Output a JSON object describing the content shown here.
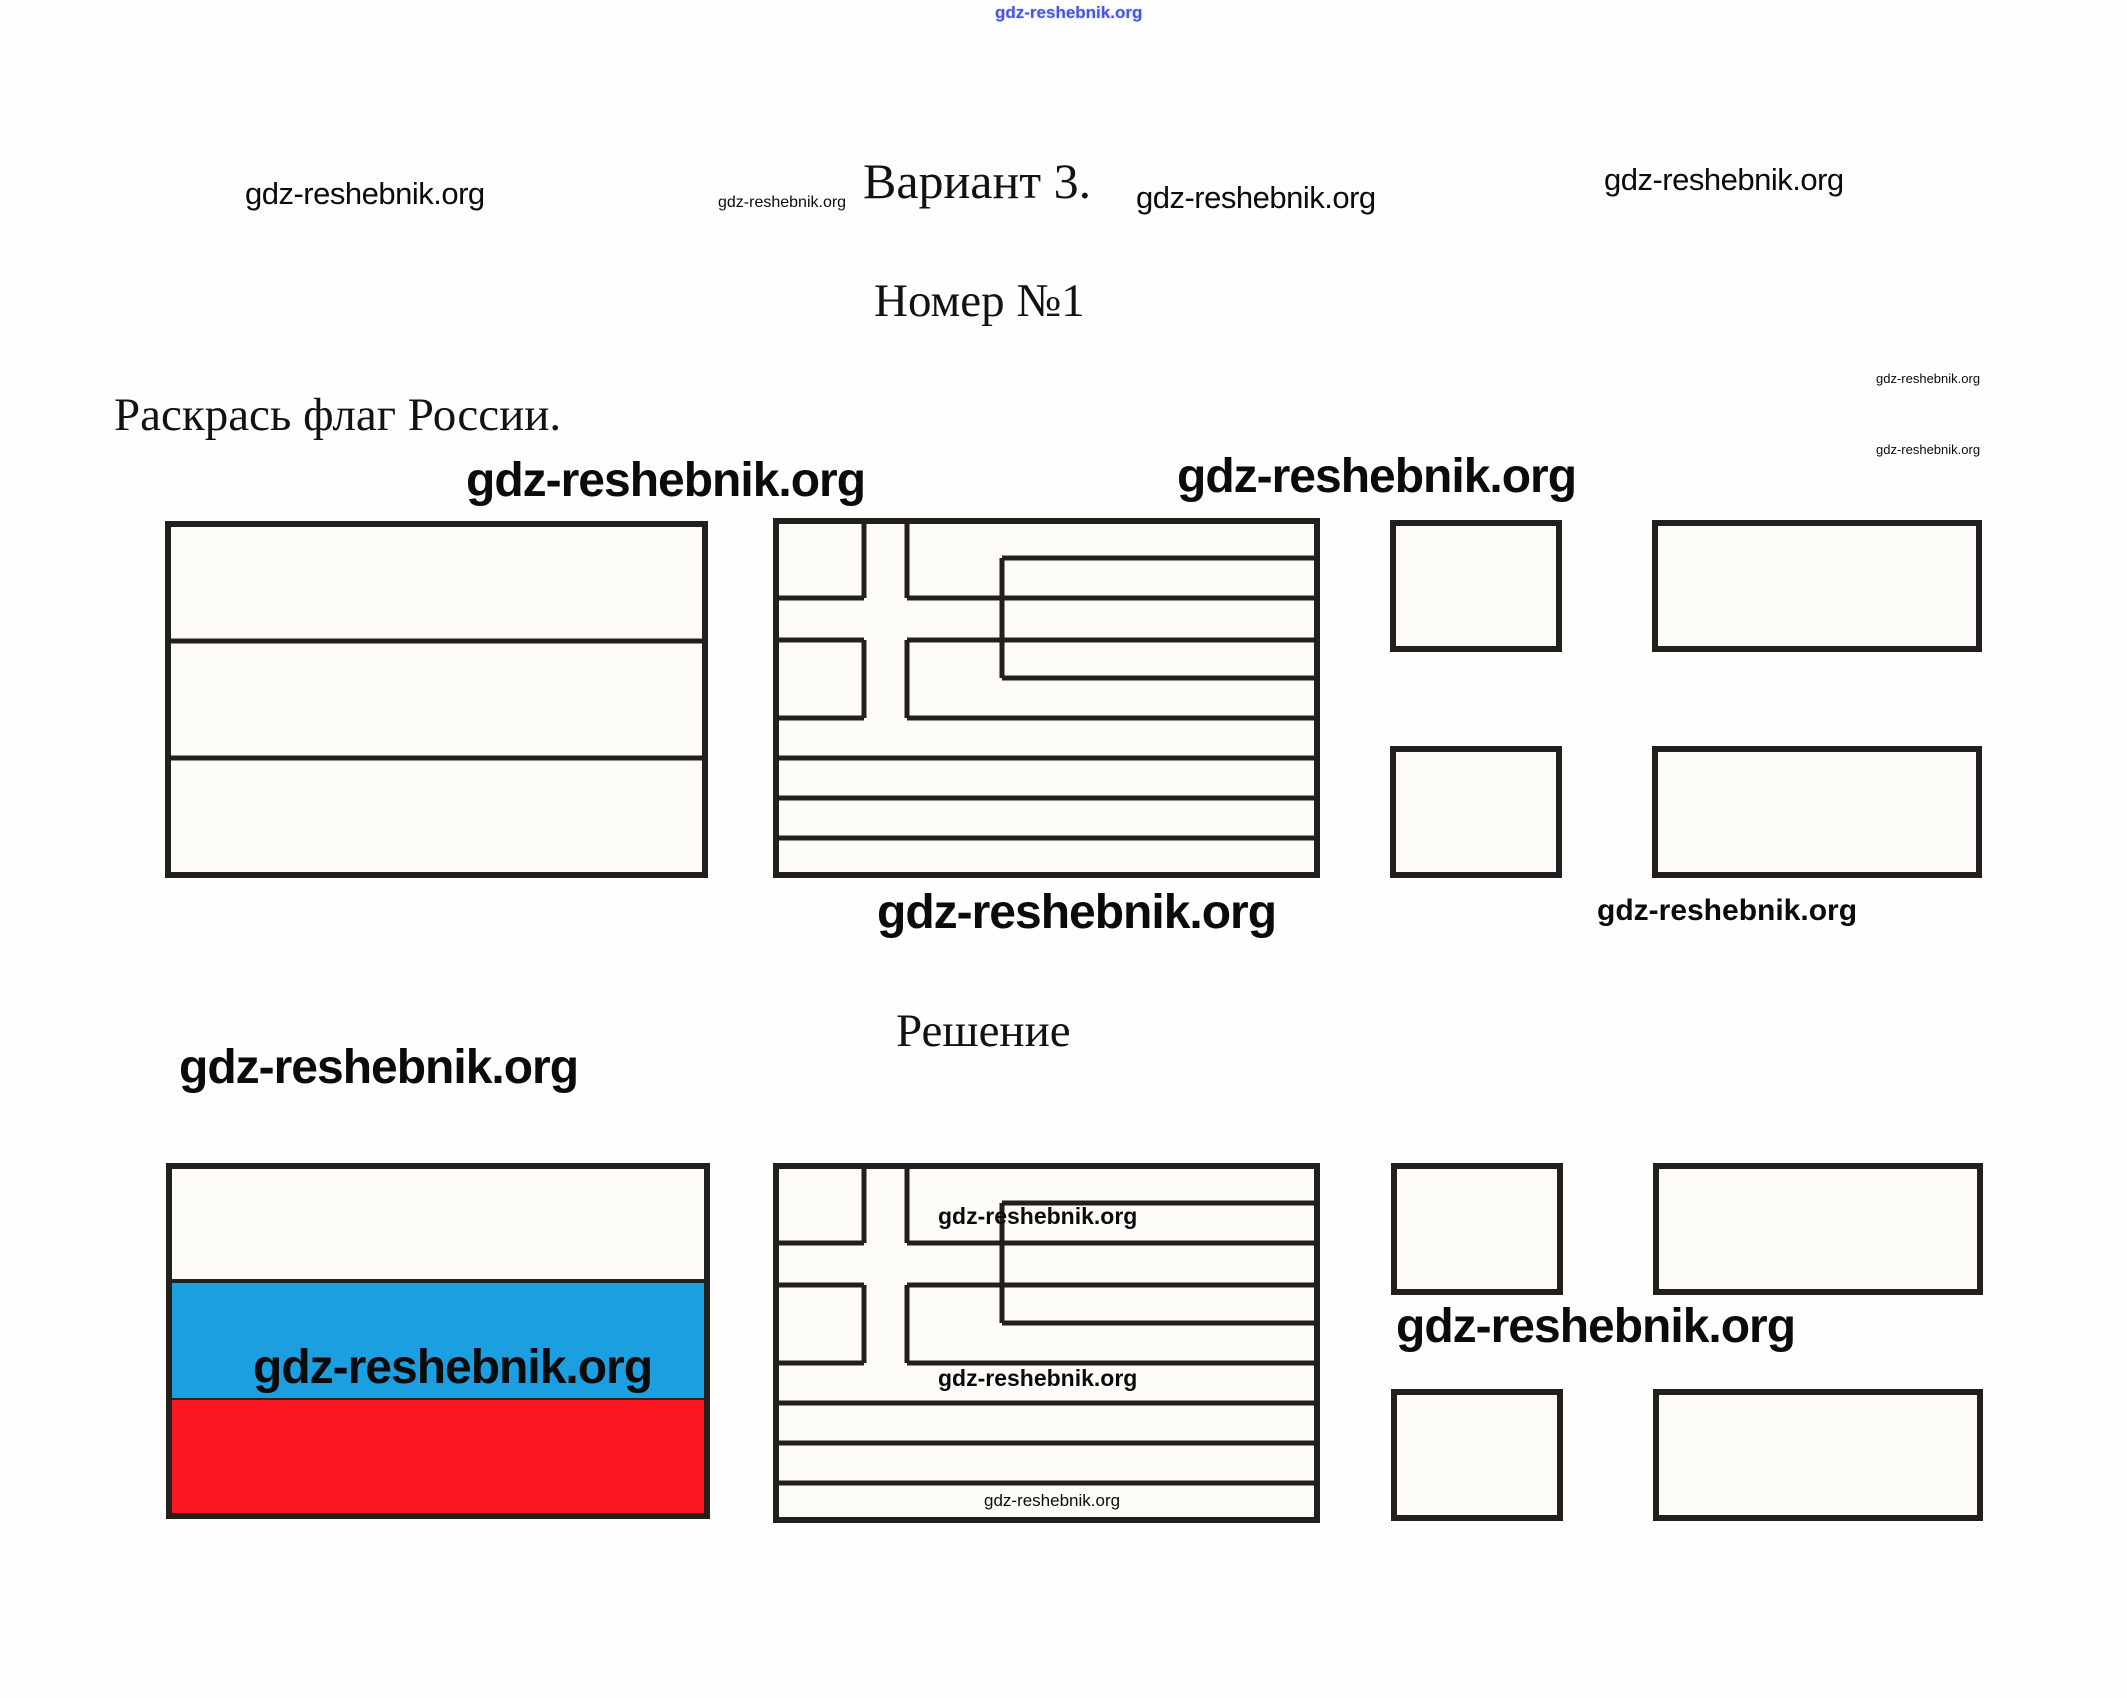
{
  "site": "gdz-reshebnik.org",
  "header": {
    "top_watermark": "gdz-reshebnik.org",
    "left_watermark": "gdz-reshebnik.org",
    "small_watermark": "gdz-reshebnik.org",
    "variant_title": "Вариант 3.",
    "variant_watermark": "gdz-reshebnik.org",
    "right_watermark": "gdz-reshebnik.org",
    "task_number": "Номер №1",
    "margin_watermark_top": "gdz-reshebnik.org",
    "margin_watermark_bottom": "gdz-reshebnik.org"
  },
  "task": {
    "prompt": "Раскрась флаг России.",
    "watermark_over_flags_left": "gdz-reshebnik.org",
    "watermark_over_flags_right": "gdz-reshebnik.org",
    "watermark_below_big": "gdz-reshebnik.org",
    "watermark_below_small": "gdz-reshebnik.org"
  },
  "solution": {
    "heading": "Решение",
    "watermark_left_big": "gdz-reshebnik.org",
    "russia_flag_watermark": "gdz-reshebnik.org",
    "greece_watermark_1": "gdz-reshebnik.org",
    "greece_watermark_2": "gdz-reshebnik.org",
    "greece_watermark_3": "gdz-reshebnik.org",
    "nordic_flag_watermark": "gdz-reshebnik.org"
  },
  "flags": {
    "row1": [
      "russia-outline",
      "greece-outline",
      "nordic-cross-outline"
    ],
    "row2": [
      "russia-colored",
      "greece-outline",
      "nordic-cross-outline"
    ],
    "russia_solution_stripes": [
      "white",
      "blue",
      "red"
    ]
  },
  "colors": {
    "flag_blue": "#1B9FE1",
    "flag_red": "#FB171F",
    "flag_white": "#FDFCF9",
    "outline": "#231F1D",
    "top_watermark_blue": "#4A55DF"
  }
}
